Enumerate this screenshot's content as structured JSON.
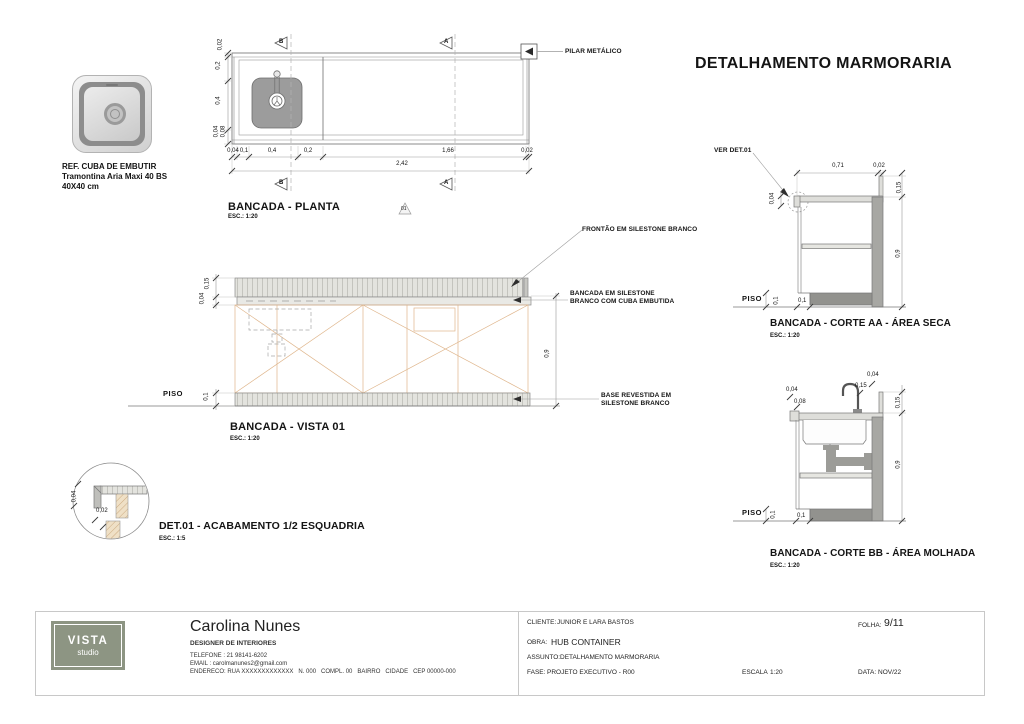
{
  "sheet": {
    "title": "DETALHAMENTO MARMORARIA"
  },
  "sink_ref": {
    "title": "REF. CUBA DE EMBUTIR",
    "model": "Tramontina Aria Maxi 40 BS",
    "size": "40X40 cm"
  },
  "plan": {
    "title": "BANCADA - PLANTA",
    "scale": "ESC.: 1:20",
    "pillar_label": "PILAR METÁLICO",
    "marker_a": "A",
    "marker_b": "B",
    "detail_ref": "01",
    "dims": {
      "bottom": [
        "0,04",
        "0,1",
        "0,4",
        "0,2",
        "1,66",
        "0,02"
      ],
      "total": "2,42",
      "left": [
        "0,02",
        "0,2",
        "0,4",
        "0,04",
        "0,08"
      ]
    }
  },
  "vista": {
    "title": "BANCADA - VISTA 01",
    "scale": "ESC.: 1:20",
    "piso": "PISO",
    "labels": {
      "frontao": "FRONTÃO EM SILESTONE BRANCO",
      "bancada1": "BANCADA EM SILESTONE",
      "bancada2": "BRANCO COM CUBA EMBUTIDA",
      "base1": "BASE REVESTIDA EM",
      "base2": "SILESTONE BRANCO"
    },
    "dims": {
      "frontal": "0,15",
      "slab": "0,04",
      "base": "0,1",
      "body": "0,9"
    }
  },
  "corte_aa": {
    "title": "BANCADA - CORTE AA - ÁREA SECA",
    "scale": "ESC.: 1:20",
    "ver_det": "VER DET.01",
    "piso": "PISO",
    "dims": {
      "top": "0,71",
      "top_edge": "0,02",
      "upstand": "0,15",
      "height": "0,9",
      "slab": "0,04",
      "toe_h": "0,1",
      "toe_w": "0,1"
    }
  },
  "corte_bb": {
    "title": "BANCADA - CORTE BB - ÁREA MOLHADA",
    "scale": "ESC.: 1:20",
    "piso": "PISO",
    "dims": {
      "edge": "0,04",
      "apron": "0,08",
      "faucet_h": "0,15",
      "faucet_off": "0,04",
      "upstand": "0,15",
      "height": "0,9",
      "toe_h": "0,1",
      "toe_w": "0,1"
    }
  },
  "det01": {
    "title": "DET.01 - ACABAMENTO 1/2 ESQUADRIA",
    "scale": "ESC.: 1:5",
    "dims": {
      "a": "0,04",
      "b": "0,02"
    }
  },
  "titleblock": {
    "logo": {
      "line1": "VISTA",
      "line2": "studio",
      "bg": "#8d9583"
    },
    "designer": {
      "name": "Carolina Nunes",
      "role": "DESIGNER DE INTERIORES",
      "phone": "TELEFONE : 21 98141-6202",
      "email": "EMAIL : carolmanunes2@gmail.com",
      "address": "ENDERECO: RUA XXXXXXXXXXXXX   N. 000   COMPL. 00   BAIRRO   CIDADE   CEP 00000-000"
    },
    "fields": {
      "cliente_label": "CLIENTE:",
      "cliente": "JUNIOR E LARA BASTOS",
      "obra_label": "OBRA:",
      "obra": "HUB CONTAINER",
      "assunto_label": "ASSUNTO:",
      "assunto": "DETALHAMENTO MARMORARIA",
      "fase_label": "FASE:",
      "fase": "PROJETO EXECUTIVO - R00",
      "escala_label": "ESCALA",
      "escala": "1:20",
      "folha_label": "FOLHA:",
      "folha": "9/11",
      "data_label": "DATA:",
      "data": "NOV/22"
    }
  },
  "colors": {
    "logo_bg": "#8d9583",
    "cabinet_line": "#dfb58b",
    "wall_gray": "#a7a7a3",
    "base_gray": "#92928e",
    "slab_gray": "#dededa"
  }
}
